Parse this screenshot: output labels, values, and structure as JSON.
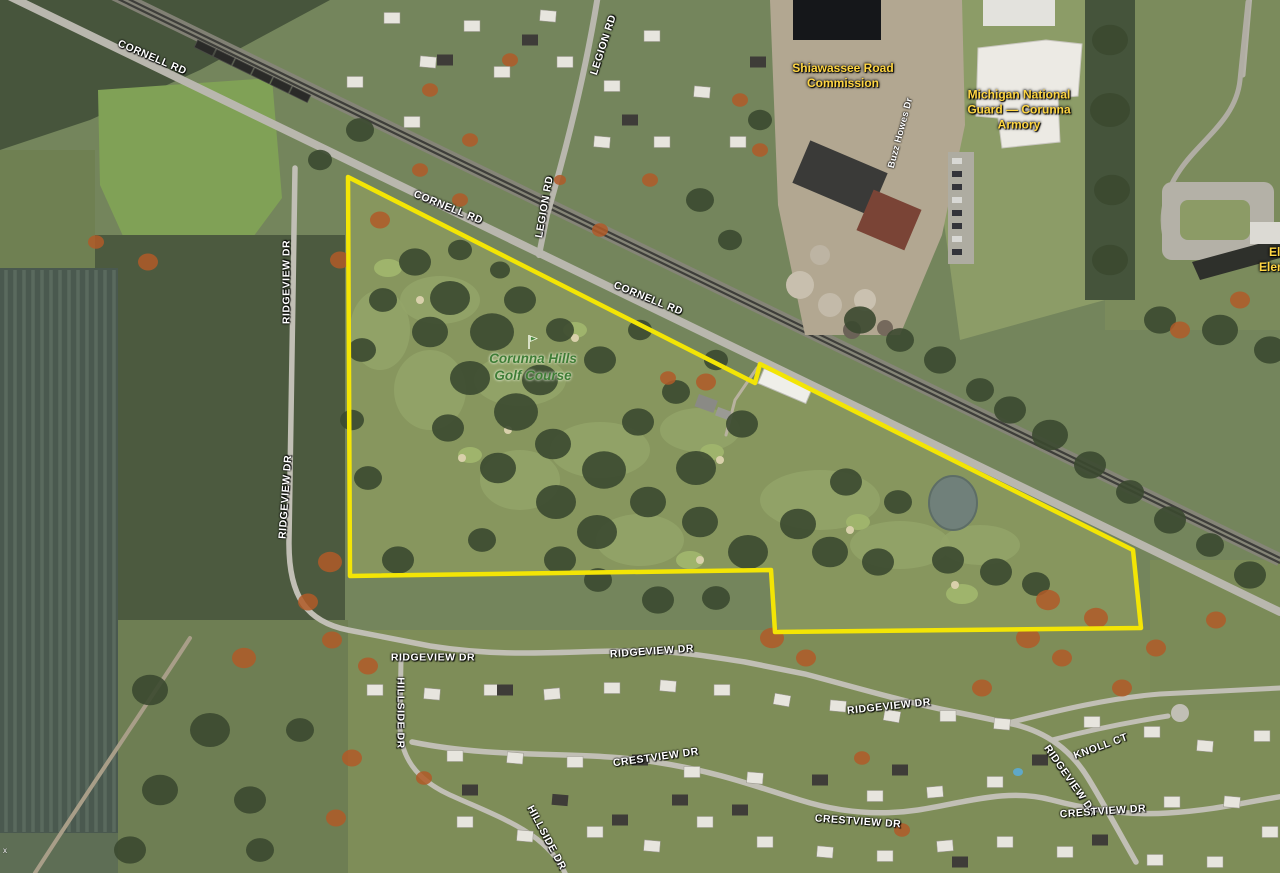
{
  "map": {
    "kind": "aerial-satellite-map",
    "place": "Corunna Hills Golf Course",
    "boundary": {
      "color": "#f3e505",
      "points": "348,177 755,383 760,364 1133,550 1141,628 775,632 771,570 350,576"
    },
    "labels": [
      {
        "kind": "road",
        "name": "cornell-rd-label",
        "text": "CORNELL RD",
        "x": 152,
        "y": 58,
        "rot": 23
      },
      {
        "kind": "road",
        "name": "cornell-rd-label",
        "text": "CORNELL RD",
        "x": 448,
        "y": 208,
        "rot": 22
      },
      {
        "kind": "road",
        "name": "cornell-rd-label",
        "text": "CORNELL RD",
        "x": 648,
        "y": 299,
        "rot": 22
      },
      {
        "kind": "road",
        "name": "legion-rd-label",
        "text": "LEGION RD",
        "x": 604,
        "y": 45,
        "rot": -72
      },
      {
        "kind": "road",
        "name": "legion-rd-label",
        "text": "LEGION RD",
        "x": 545,
        "y": 207,
        "rot": -80
      },
      {
        "kind": "road",
        "name": "ridgeview-dr-label",
        "text": "RIDGEVIEW DR",
        "x": 287,
        "y": 282,
        "rot": -90
      },
      {
        "kind": "road",
        "name": "ridgeview-dr-label",
        "text": "RIDGEVIEW DR",
        "x": 286,
        "y": 497,
        "rot": -86
      },
      {
        "kind": "road-sm",
        "name": "buzz-howes-dr-label",
        "text": "Buzz Howes Dr",
        "x": 901,
        "y": 133,
        "rot": -75
      },
      {
        "kind": "road",
        "name": "ridgeview-dr-label",
        "text": "RIDGEVIEW DR",
        "x": 433,
        "y": 658,
        "rot": 0
      },
      {
        "kind": "road",
        "name": "ridgeview-dr-label",
        "text": "RIDGEVIEW DR",
        "x": 652,
        "y": 652,
        "rot": -4
      },
      {
        "kind": "road",
        "name": "ridgeview-dr-label",
        "text": "RIDGEVIEW DR",
        "x": 889,
        "y": 707,
        "rot": -6
      },
      {
        "kind": "road",
        "name": "ridgeview-dr-label",
        "text": "RIDGEVIEW DR",
        "x": 1070,
        "y": 781,
        "rot": 55
      },
      {
        "kind": "road",
        "name": "knoll-ct-label",
        "text": "KNOLL CT",
        "x": 1101,
        "y": 747,
        "rot": -20
      },
      {
        "kind": "road",
        "name": "crestview-dr-label",
        "text": "CRESTVIEW DR",
        "x": 656,
        "y": 758,
        "rot": -8
      },
      {
        "kind": "road",
        "name": "crestview-dr-label",
        "text": "CRESTVIEW DR",
        "x": 858,
        "y": 822,
        "rot": 4
      },
      {
        "kind": "road",
        "name": "crestview-dr-label",
        "text": "CRESTVIEW DR",
        "x": 1103,
        "y": 812,
        "rot": -4
      },
      {
        "kind": "road",
        "name": "hillside-dr-label",
        "text": "HILLSIDE DR",
        "x": 400,
        "y": 713,
        "rot": 90
      },
      {
        "kind": "road",
        "name": "hillside-dr-label",
        "text": "HILLSIDE DR",
        "x": 546,
        "y": 838,
        "rot": 62
      },
      {
        "kind": "poi",
        "name": "shiawassee-road-commission-label",
        "lines": [
          "Shiawassee Road",
          "Commission"
        ],
        "x": 843,
        "y": 76,
        "rot": 0
      },
      {
        "kind": "poi",
        "name": "michigan-national-guard-armory-label",
        "lines": [
          "Michigan National",
          "Guard — Corunna",
          "Armory"
        ],
        "x": 1019,
        "y": 110,
        "rot": 0
      },
      {
        "kind": "poi",
        "name": "elsa-elementary-label",
        "lines": [
          "Elsa M",
          "Elementar"
        ],
        "x": 1288,
        "y": 260,
        "rot": 0
      },
      {
        "kind": "golf",
        "name": "corunna-hills-golf-course-label",
        "lines": [
          "Corunna Hills",
          "Golf Course"
        ],
        "x": 533,
        "y": 368,
        "rot": 0
      },
      {
        "kind": "golficon",
        "name": "golf-flag-icon",
        "x": 532,
        "y": 343,
        "rot": 0
      },
      {
        "kind": "artifact",
        "name": "map-edge-artifact",
        "text": "x",
        "x": 5,
        "y": 851,
        "rot": 0
      }
    ]
  }
}
